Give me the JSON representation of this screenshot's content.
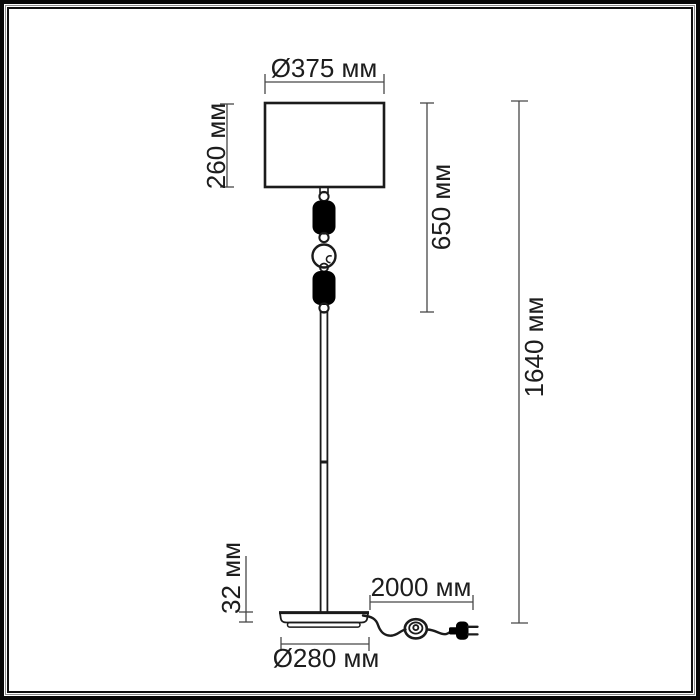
{
  "diagram": {
    "type": "technical-dimension-drawing",
    "subject": "floor lamp with cylindrical shade, decorative glass stem, round base, inline switch and plug",
    "unit": "мм",
    "colors": {
      "line": "#1b1b1b",
      "dimension_line": "#474747",
      "background": "#ffffff",
      "solid_fill": "#000000"
    },
    "dimensions": {
      "shade_diameter": {
        "label": "Ø375 мм",
        "value": 375
      },
      "shade_height": {
        "label": "260 мм",
        "value": 260
      },
      "upper_section_height": {
        "label": "650 мм",
        "value": 650
      },
      "total_height": {
        "label": "1640 мм",
        "value": 1640
      },
      "base_height": {
        "label": "32 мм",
        "value": 32
      },
      "cord_length": {
        "label": "2000 мм",
        "value": 2000
      },
      "base_diameter": {
        "label": "Ø280 мм",
        "value": 280
      }
    }
  }
}
